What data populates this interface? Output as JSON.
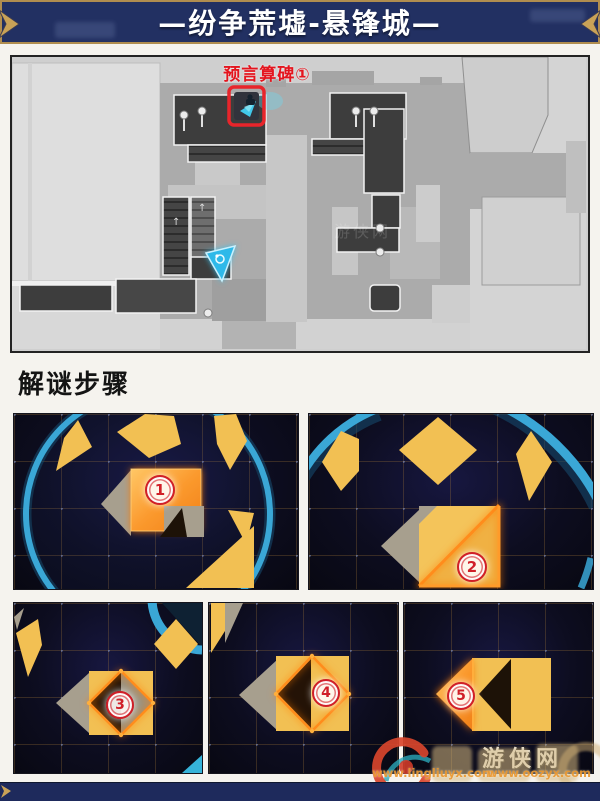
{
  "header": {
    "title": "—纷争荒墟-悬锋城—",
    "bar_color": "#223062",
    "border_gold": "#b08d4f",
    "text_color": "#ffffff"
  },
  "map": {
    "label": "预言算碑①",
    "label_color": "#e4151e",
    "watermark": "游侠网"
  },
  "section": {
    "heading": "解谜步骤"
  },
  "steps": [
    {
      "num": "1"
    },
    {
      "num": "2"
    },
    {
      "num": "3"
    },
    {
      "num": "4"
    },
    {
      "num": "5"
    }
  ],
  "watermarks": {
    "site_name": "游侠网",
    "url_left": "www.lingliuyx.com",
    "url_right": "www.oozyx.com"
  },
  "icons": {
    "header_left": "chevron-right-ornament-icon",
    "header_right": "chevron-left-ornament-icon",
    "map_marker": "prophecy-monument-marker-icon",
    "map_player": "player-arrow-icon",
    "footer_left": "chevron-ornament-icon",
    "bottom_logo": "site-logo-icon"
  },
  "colors": {
    "page_bg": "#f5f3ee",
    "puzzle_bg": "#0d0d20",
    "accent_yellow": "#f2c053",
    "glow_orange": "#ff8c1a",
    "taupe_gray": "#a79f8e",
    "dark_shape": "#1d1207",
    "ring_cyan": "#3aa7d6",
    "badge_red": "#d01f28",
    "navy": "#1e2a5c",
    "gold": "#b08d4f"
  }
}
